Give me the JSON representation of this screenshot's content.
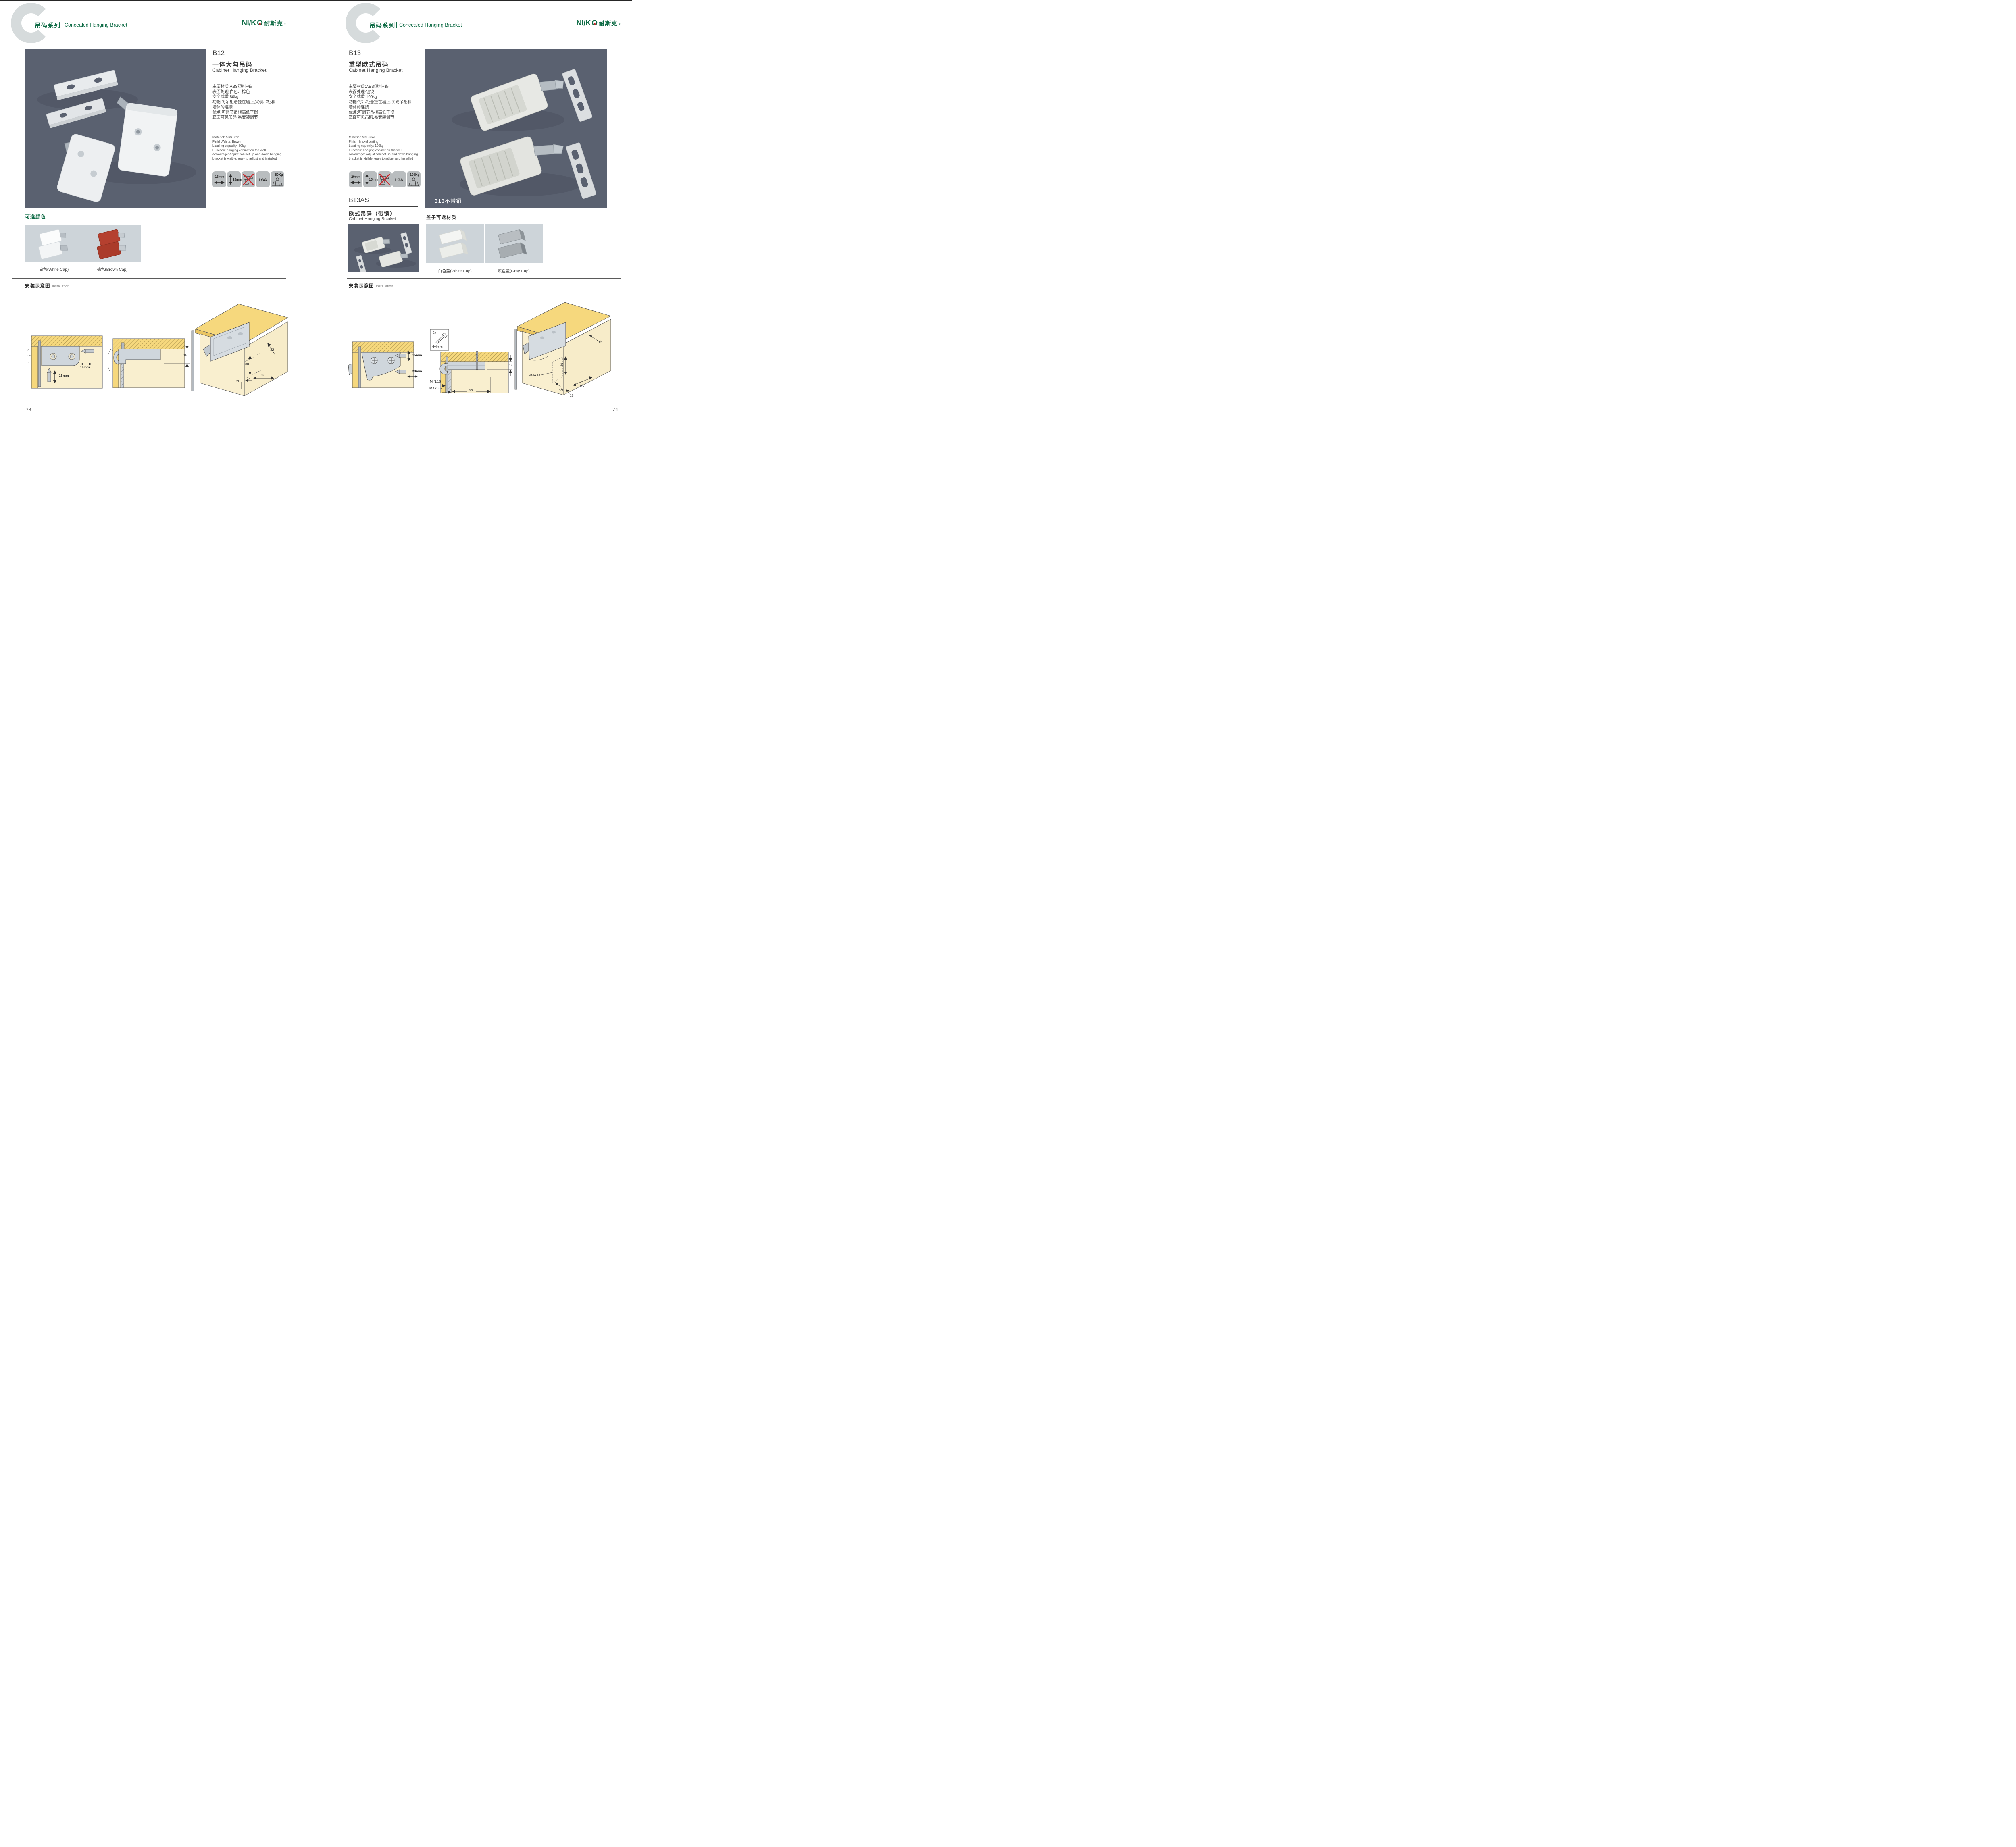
{
  "brand": {
    "logo_left": "NI/K",
    "logo_o": "O",
    "logo_cn": "耐斯克",
    "reg": "®"
  },
  "header": {
    "watermark": "C",
    "series_cn": "吊码系列",
    "series_en": "Concealed Hanging Bracket"
  },
  "left": {
    "page_number": "73",
    "product": {
      "code": "B12",
      "name_cn": "一体大勾吊码",
      "name_en": "Cabinet Hanging Bracket",
      "specs_cn": [
        "主要材质:ABS塑料+铁",
        "表面处理:白色、棕色",
        "安全载重:80kg",
        "功能:将吊柜悬挂在墙上,实现吊柜和",
        "墙体的连接",
        "优点:可调节吊柜高低平衡",
        "正面可见吊码,易安装调节"
      ],
      "specs_en": [
        "Material: ABS+iron",
        "Finish:White, Brown",
        "Loading capacity: 80kg",
        "Function: hanging cabinet on the wall",
        "Advantage: Adjust cabinet up and down hanging",
        "bracket is visible, easy to adjust and installed"
      ],
      "icons": {
        "width": "16mm",
        "height": "15mm",
        "cert": "LGA",
        "load": "80Kg"
      }
    },
    "colors": {
      "title": "可选颜色",
      "captions": [
        "白色(White Cap)",
        "棕色(Brown Cap)"
      ]
    },
    "install": {
      "title_cn": "安装示意图",
      "title_en": "Installation",
      "d1": {
        "width": "16mm",
        "height": "15mm"
      },
      "d2": {
        "depth": "18"
      },
      "d3": {
        "dim_a": "33",
        "dim_b": "30",
        "dim_c": "32",
        "dim_d": "20",
        "dim_e": "14"
      }
    }
  },
  "right": {
    "page_number": "74",
    "product": {
      "code": "B13",
      "name_cn": "重型欧式吊码",
      "name_en": "Cabinet Hanging Bracket",
      "specs_cn": [
        "主要材质:ABS塑料+铁",
        "表面处理:镀镍",
        "安全载重:100kg",
        "功能:将吊柜悬挂在墙上,实现吊柜和",
        "墙体的连接",
        "优点:可调节吊柜高低平衡",
        "正面可见吊码,易安装调节"
      ],
      "specs_en": [
        "Material: ABS+iron",
        "Finish: Nickel plating",
        "Loading capacity: 100kg",
        "Function: hanging cabinet on the wall",
        "Advantage: Adjust cabinet up and down hanging",
        "bracket is visible, easy to adjust and installed"
      ],
      "icons": {
        "width": "20mm",
        "height": "15mm",
        "cert": "LGA",
        "load": "100Kg"
      }
    },
    "photo_label": "B13不带销",
    "sub_product": {
      "code": "B13AS",
      "name_cn": "欧式吊码（带销）",
      "name_en": "Cabinet Hanging Brcaket"
    },
    "covers": {
      "title": "盖子可选材质",
      "captions": [
        "白色盖(White Cap)",
        "灰色盖(Gray Cap)"
      ]
    },
    "install": {
      "title_cn": "安装示意图",
      "title_en": "Installation",
      "d1": {
        "height": "15mm",
        "width": "20mm"
      },
      "d2": {
        "screw_qty": "2x",
        "screw_dia": "Φ4mm",
        "depth": "18",
        "min": "MIN.15",
        "max": "MAX.35",
        "span": "58"
      },
      "d3": {
        "dim_a": "16",
        "dim_b": "40",
        "dim_c": "RMAX4",
        "dim_d": "19",
        "dim_e": "18",
        "dim_f": "32"
      }
    }
  }
}
